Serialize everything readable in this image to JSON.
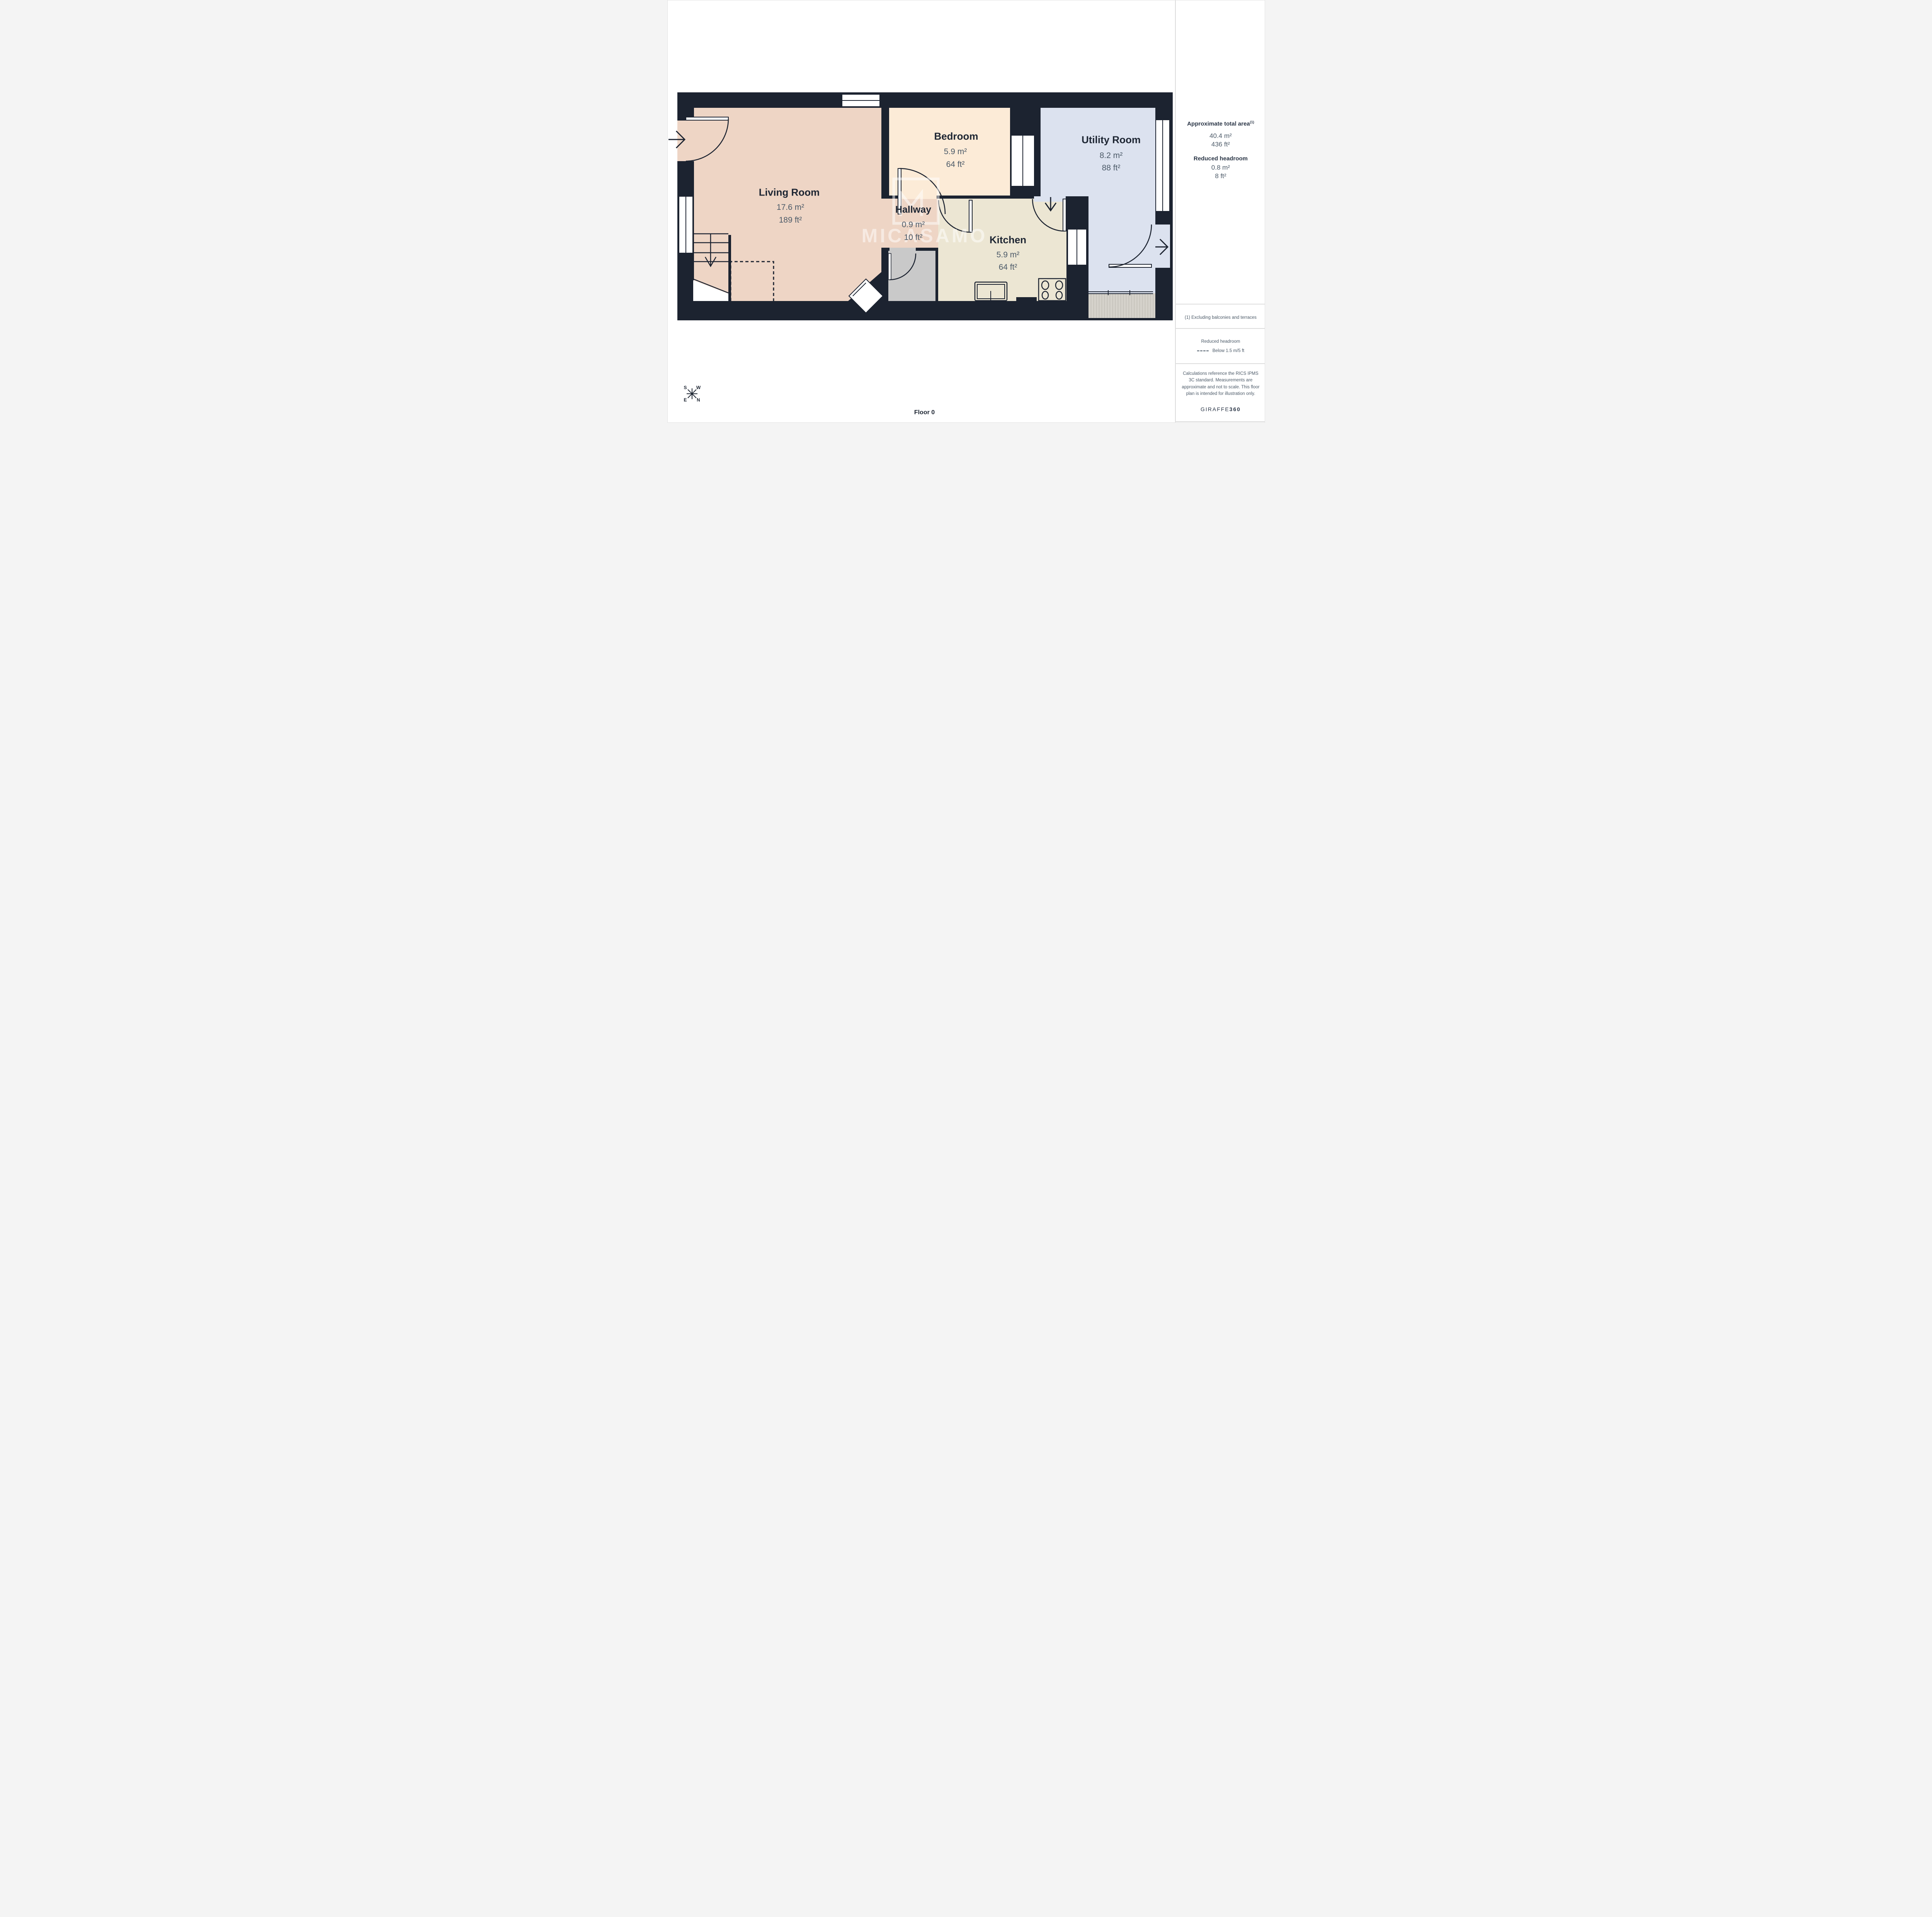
{
  "floor_label": "Floor 0",
  "watermark": {
    "text": "MICASAMO",
    "logo_letter": "M"
  },
  "compass": {
    "top_left": "S",
    "top_right": "W",
    "bottom_left": "E",
    "bottom_right": "N"
  },
  "rooms": {
    "living": {
      "name": "Living Room",
      "area_m": "17.6 m²",
      "area_ft": "189 ft²"
    },
    "bedroom": {
      "name": "Bedroom",
      "area_m": "5.9 m²",
      "area_ft": "64 ft²"
    },
    "hallway": {
      "name": "Hallway",
      "area_m": "0.9 m²",
      "area_ft": "10 ft²"
    },
    "kitchen": {
      "name": "Kitchen",
      "area_m": "5.9 m²",
      "area_ft": "64 ft²"
    },
    "utility": {
      "name": "Utility Room",
      "area_m": "8.2 m²",
      "area_ft": "88 ft²"
    }
  },
  "sidebar": {
    "total_area_heading": "Approximate total area",
    "total_area_heading_sup": "(1)",
    "total_area_m": "40.4 m²",
    "total_area_ft": "436 ft²",
    "reduced_headroom_heading": "Reduced headroom",
    "reduced_headroom_m": "0.8 m²",
    "reduced_headroom_ft": "8 ft²",
    "footnote": "(1) Excluding balconies and terraces",
    "legend_title": "Reduced headroom",
    "legend_item": "Below 1.5 m/5 ft",
    "disclaimer": "Calculations reference the RICS IPMS 3C standard. Measurements are approximate and not to scale. This floor plan is intended for illustration only.",
    "brand_name": "GIRAFFE",
    "brand_suffix": "360"
  },
  "colors": {
    "wall": "#1c2330",
    "living": "#eed5c5",
    "bedroom": "#fcebd7",
    "utility": "#dce2ef",
    "kitchen": "#ece6d3",
    "cupboard": "#c9c9c9",
    "mat": "#d5d2cb",
    "mat_stripe": "#c2bfb7",
    "ink": "#1e2633",
    "ink2": "#4c5a68",
    "ink3": "#2b3647"
  }
}
